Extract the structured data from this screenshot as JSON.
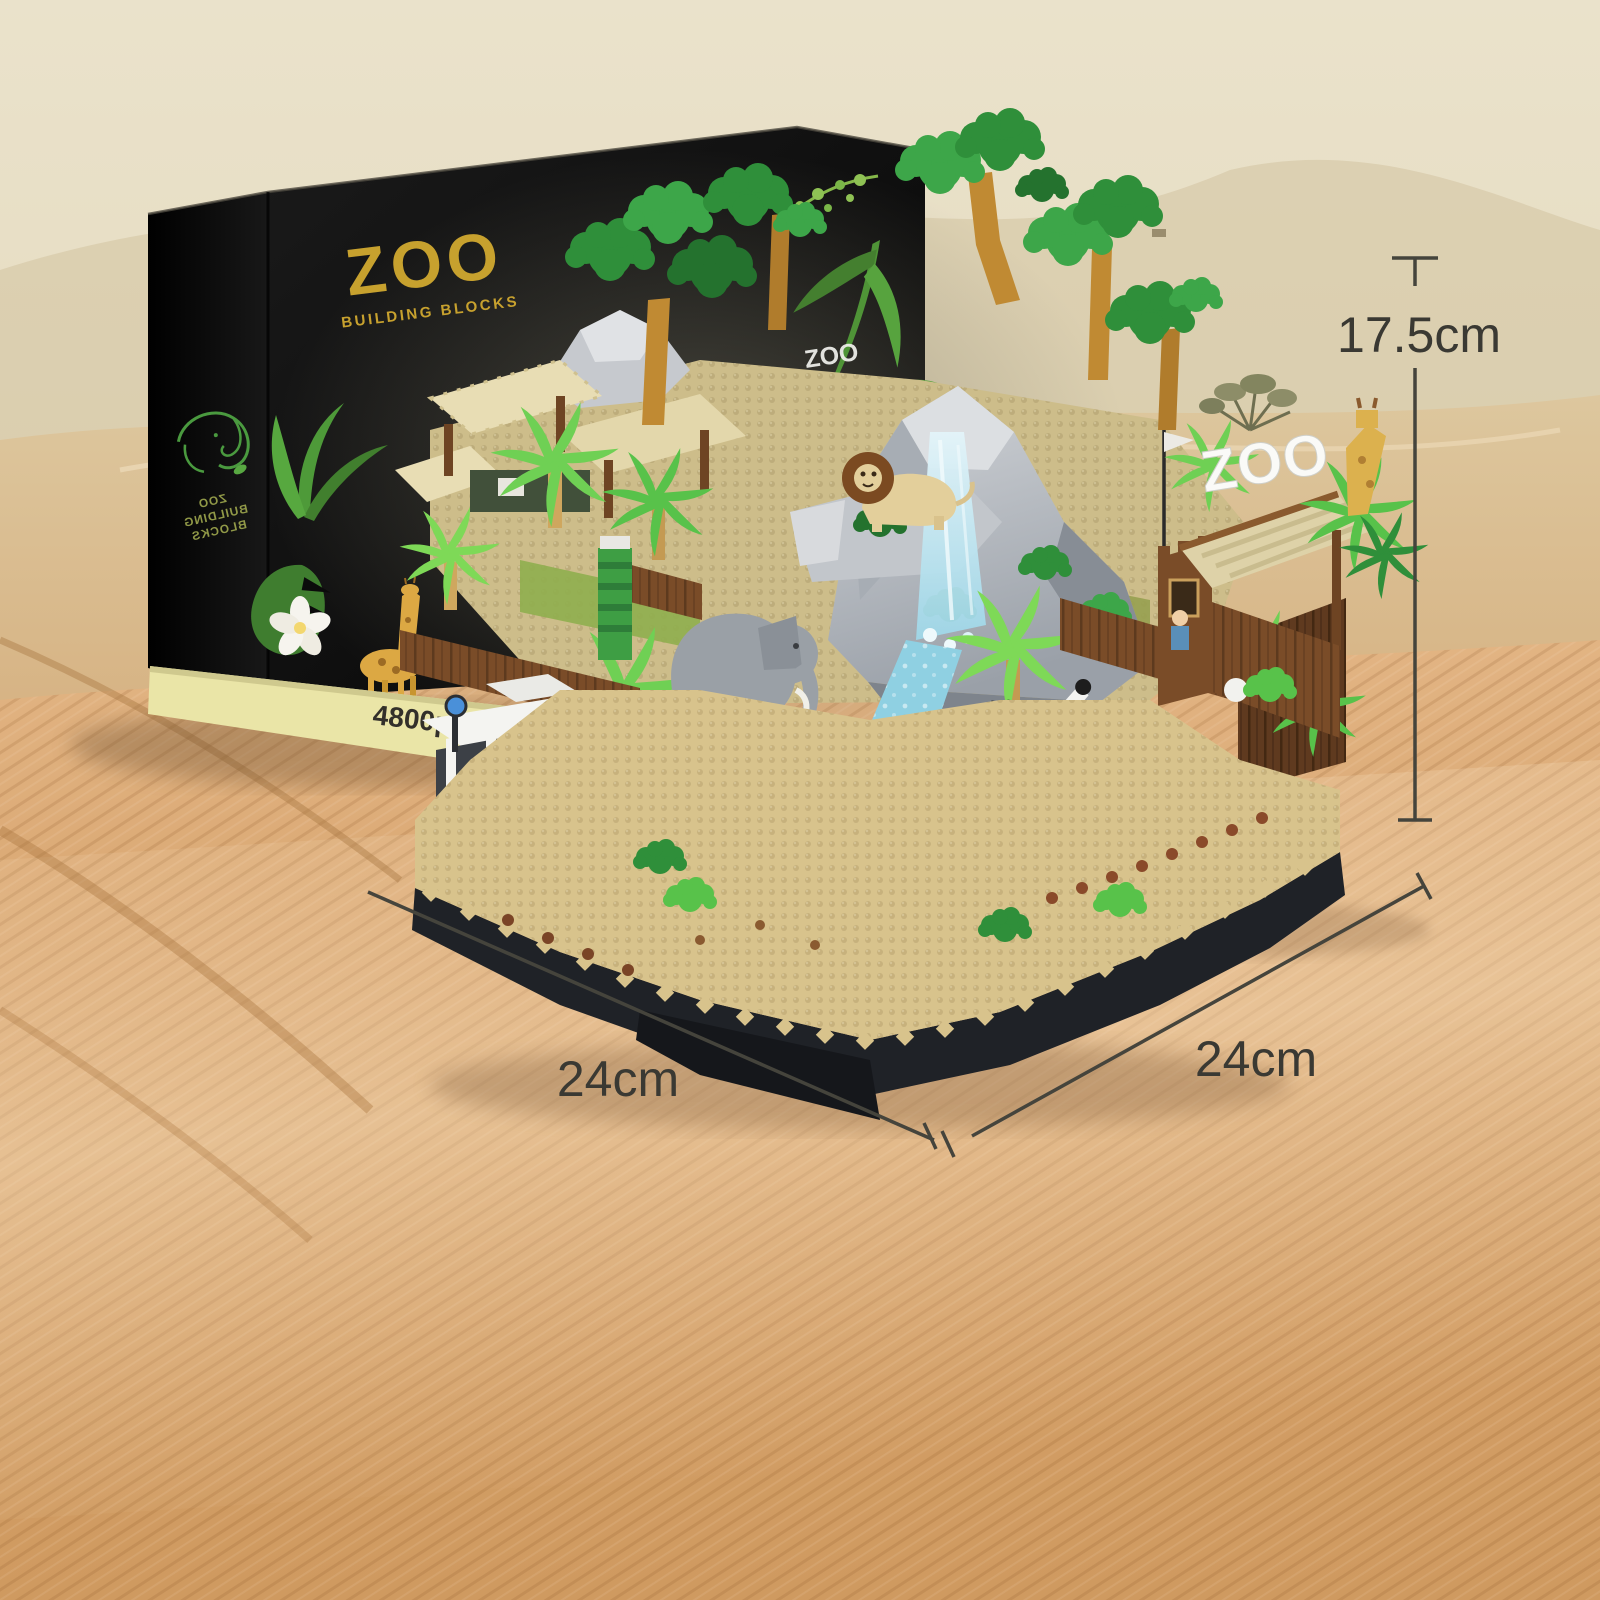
{
  "box": {
    "logo_title": "ZOO",
    "logo_subtitle": "BUILDING BLOCKS",
    "side_line1": "ZOO",
    "side_line2": "BUILDING",
    "side_line3": "BLOCKS",
    "art_gate_sign": "ZOO",
    "piece_count": "4800pcs+"
  },
  "model": {
    "gate_sign": "ZOO",
    "park_sign_line1": "AFRICA",
    "park_sign_line2": "PARK"
  },
  "dimensions": {
    "height_label": "17.5cm",
    "width_left_label": "24cm",
    "width_right_label": "24cm"
  },
  "palette": {
    "gold": "#c7a12e",
    "boxBlack": "#0b0b0b",
    "cream": "#eae5a7",
    "plate": "#d8c38c",
    "baseDark": "#1f2227",
    "rock": "#b7bbc1",
    "rockDark": "#8d939b",
    "water": "#8fd0e2",
    "green": "#3e9e44",
    "greenDark": "#2a7a33",
    "lime": "#7ed957",
    "trunk": "#c08a33",
    "fence": "#7a4c28",
    "fenceDark": "#5d3a1e",
    "zebra": "#f4f4f2",
    "elephantGray": "#9aa0a6",
    "tramYellow": "#e9c53d",
    "dimLine": "#45443c",
    "dimText": "#3a3933",
    "sandTop": "#e8dfc6",
    "sandMid": "#d9b98c",
    "sandDeep": "#cf9a60"
  }
}
